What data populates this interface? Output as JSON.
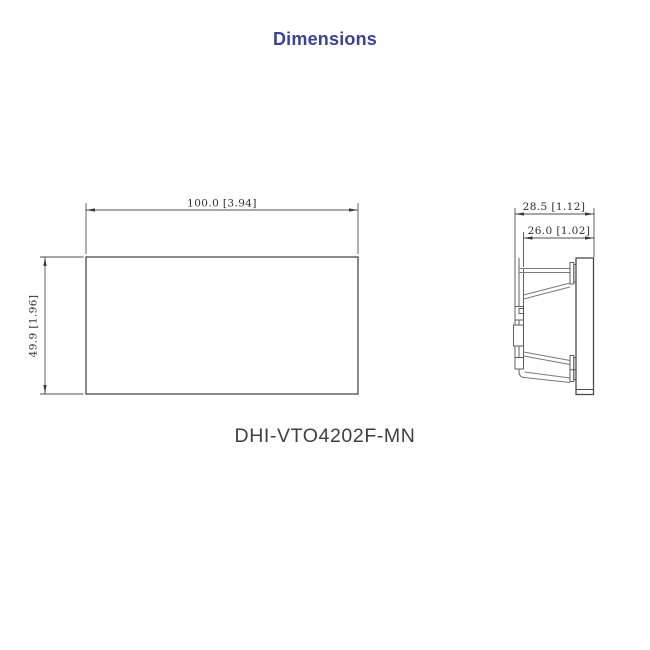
{
  "page": {
    "title": "Dimensions",
    "model_number": "DHI-VTO4202F-MN"
  },
  "colors": {
    "title_accent": "#3a3fa8",
    "drawing_lines": "#4f4f4f",
    "dimension_text": "#2e2e2e"
  },
  "front_view": {
    "width_label": "100.0 [3.94]",
    "height_label": "49.9 [1.96]"
  },
  "side_view": {
    "total_depth_label": "28.5 [1.12]",
    "body_depth_label": "26.0 [1.02]"
  }
}
